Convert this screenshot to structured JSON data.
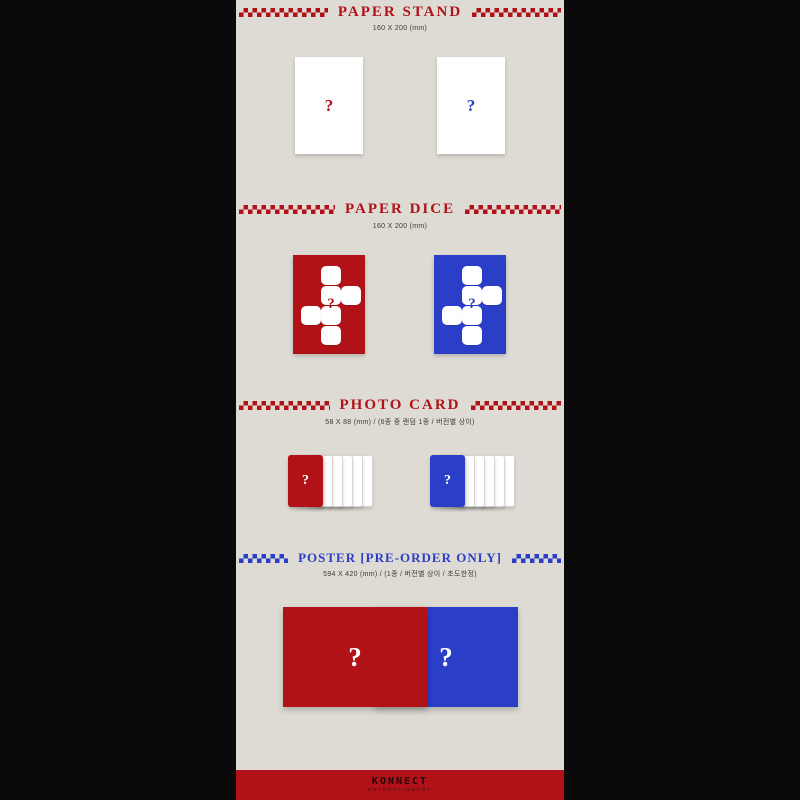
{
  "colors": {
    "page_bg": "#0a0a0a",
    "panel_bg": "#dedbd4",
    "red": "#b11217",
    "blue": "#2b3ec7"
  },
  "qmark": "?",
  "sections": [
    {
      "title": "PAPER STAND",
      "subtitle": "160 X 200 (mm)"
    },
    {
      "title": "PAPER DICE",
      "subtitle": "160 X 200 (mm)"
    },
    {
      "title": "PHOTO CARD",
      "subtitle": "58 X 88 (mm) / (6종 중 랜덤 1종 / 버전별 상이)"
    },
    {
      "title": "POSTER [PRE-ORDER ONLY]",
      "subtitle": "594 X 420 (mm) / (1종 / 버전별 상이 / 초도한정)"
    }
  ],
  "footer": {
    "logo": "KONNECT",
    "logo_sub": "ENTERTAINMENT"
  }
}
